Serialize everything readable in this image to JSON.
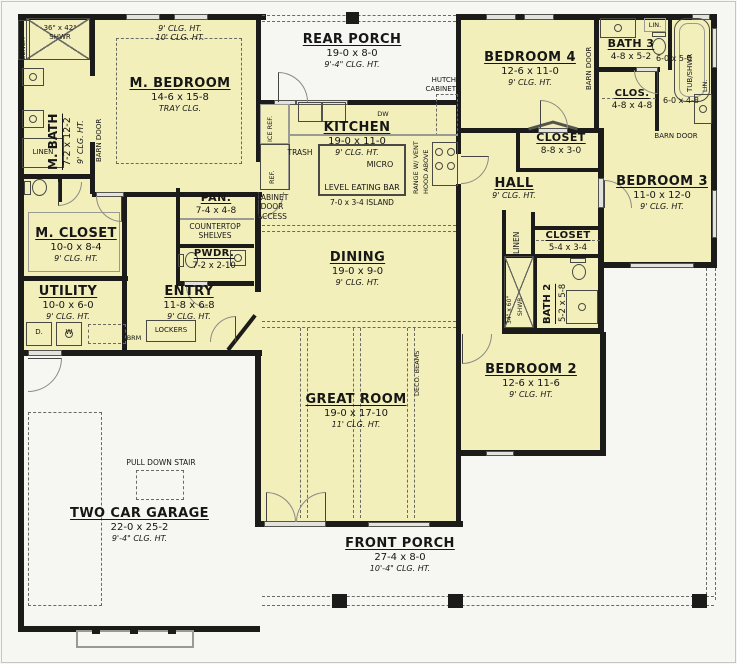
{
  "colors": {
    "room_fill": "#f2efba",
    "wall": "#1b1b19",
    "window": "#e3e3de",
    "paper": "#f6f6f2"
  },
  "rooms": [
    {
      "id": "m-bath",
      "name": "M. BATH",
      "dims": "7-2 x 12-2",
      "clg": "9' CLG. HT."
    },
    {
      "id": "m-bedroom",
      "name": "M. BEDROOM",
      "dims": "14-6 x 15-8",
      "clg": "TRAY CLG."
    },
    {
      "id": "rear-porch",
      "name": "REAR PORCH",
      "dims": "19-0 x 8-0",
      "clg": "9'-4\" CLG. HT."
    },
    {
      "id": "kitchen",
      "name": "KITCHEN",
      "dims": "19-0 x 11-0",
      "clg": "9' CLG. HT."
    },
    {
      "id": "bedroom-4",
      "name": "BEDROOM 4",
      "dims": "12-6 x 11-0",
      "clg": "9' CLG. HT."
    },
    {
      "id": "bath-3",
      "name": "BATH 3",
      "dims": "4-8 x 5-2"
    },
    {
      "id": "clos",
      "name": "CLOS.",
      "dims": "4-8 x 4-8"
    },
    {
      "id": "closet-hall",
      "name": "CLOSET",
      "dims": "8-8 x 3-0"
    },
    {
      "id": "hall",
      "name": "HALL",
      "clg": "9' CLG. HT."
    },
    {
      "id": "bedroom-3",
      "name": "BEDROOM 3",
      "dims": "11-0 x 12-0",
      "clg": "9' CLG. HT."
    },
    {
      "id": "m-closet",
      "name": "M. CLOSET",
      "dims": "10-0 x 8-4",
      "clg": "9' CLG. HT."
    },
    {
      "id": "pantry",
      "name": "PAN.",
      "dims": "7-4 x 4-8"
    },
    {
      "id": "powder",
      "name": "PWDR.",
      "dims": "7-2 x 2-10"
    },
    {
      "id": "dining",
      "name": "DINING",
      "dims": "19-0 x 9-0",
      "clg": "9' CLG. HT."
    },
    {
      "id": "utility",
      "name": "UTILITY",
      "dims": "10-0 x 6-0",
      "clg": "9' CLG. HT."
    },
    {
      "id": "entry",
      "name": "ENTRY",
      "dims": "11-8 x 6-8",
      "clg": "9' CLG. HT."
    },
    {
      "id": "closet-2",
      "name": "CLOSET",
      "dims": "5-4 x 3-4"
    },
    {
      "id": "bath-2",
      "name": "BATH 2",
      "dims": "5-2 x 5-8"
    },
    {
      "id": "bedroom-2",
      "name": "BEDROOM 2",
      "dims": "12-6 x 11-6",
      "clg": "9' CLG. HT."
    },
    {
      "id": "great-room",
      "name": "GREAT ROOM",
      "dims": "19-0 x 17-10",
      "clg": "11' CLG. HT."
    },
    {
      "id": "garage",
      "name": "TWO CAR GARAGE",
      "dims": "22-0 x 25-2",
      "clg": "9'-4\" CLG. HT."
    },
    {
      "id": "front-porch",
      "name": "FRONT PORCH",
      "dims": "27-4 x 8-0",
      "clg": "10'-4\" CLG. HT."
    }
  ],
  "ann": {
    "bench": "BENCH",
    "shwr_m1": "36\" x 42\"",
    "shwr_m2": "SHWR",
    "shwr2_1": "34\" x 60\"",
    "linen": "LINEN",
    "barn_door": "BARN DOOR",
    "tray9": "9' CLG. HT.",
    "tray10": "10' CLG. HT.",
    "hutch1": "HUTCH",
    "hutch2": "CABINET",
    "dw": "DW",
    "ice_ref": "ICE REF.",
    "ref": "REF.",
    "trash": "TRASH",
    "micro": "MICRO",
    "eating_bar": "LEVEL EATING BAR",
    "island": "7-0 x 3-4 ISLAND",
    "range1": "RANGE W/ VENT",
    "range2": "HOOD ABOVE",
    "lin": "LIN.",
    "tub": "TUB/SHWR",
    "d6050": "6-0 x 5-0",
    "d6048": "6-0 x 4-8",
    "counter1": "COUNTERTOP",
    "counter2": "SHELVES",
    "cab1": "CABINET",
    "cab2": "DOOR",
    "cab3": "ACCESS",
    "lockers": "LOCKERS",
    "brm": "BRM",
    "d": "D.",
    "w": "W",
    "deco": "DECO. BEAMS",
    "pulldown": "PULL DOWN STAIR"
  }
}
